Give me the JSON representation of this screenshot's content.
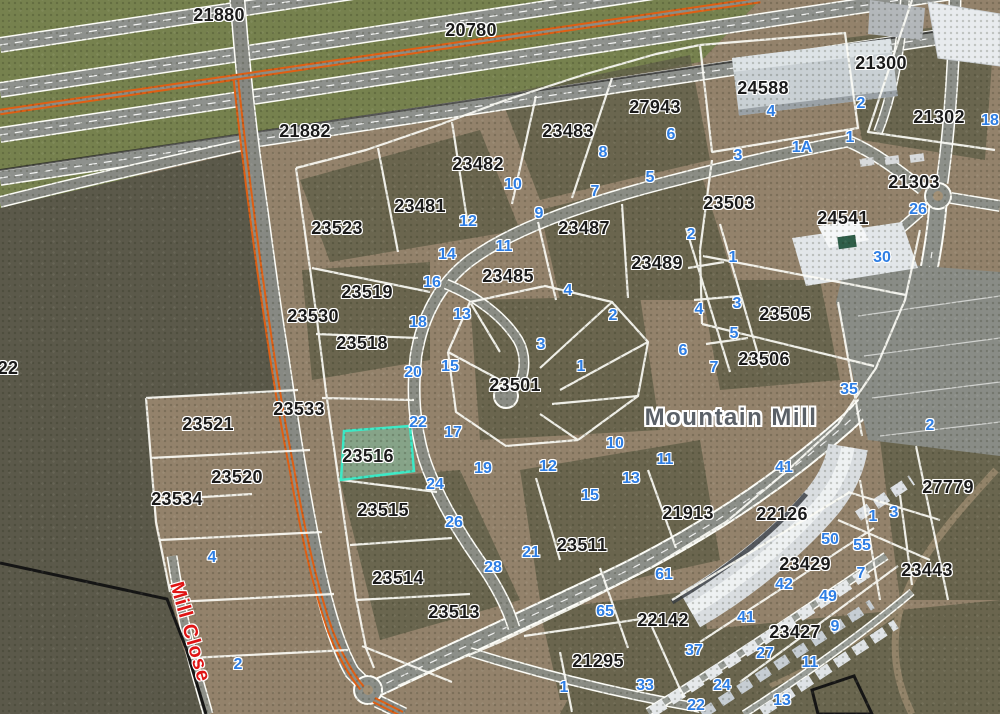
{
  "map": {
    "area_label": "Mountain Mill",
    "street_label": "Mill Close",
    "highlighted_parcel": {
      "id": "23516"
    },
    "colors": {
      "parcel_line": "#fbfbf5",
      "parcel_label": "#1a1a1a",
      "street_number": "#2e7ee4",
      "street_name": "#df1414",
      "area_label": "#5a6067",
      "route_overlay": "#df5f14",
      "highlight_fill": "#7cbfa0",
      "highlight_border": "#3ce9c6"
    },
    "parcel_labels": [
      {
        "t": "21880",
        "x": 219,
        "y": 15
      },
      {
        "t": "20780",
        "x": 471,
        "y": 30
      },
      {
        "t": "21882",
        "x": 305,
        "y": 131
      },
      {
        "t": "24588",
        "x": 763,
        "y": 88
      },
      {
        "t": "21300",
        "x": 881,
        "y": 63
      },
      {
        "t": "27943",
        "x": 655,
        "y": 107
      },
      {
        "t": "23483",
        "x": 568,
        "y": 131
      },
      {
        "t": "21302",
        "x": 939,
        "y": 117
      },
      {
        "t": "23482",
        "x": 478,
        "y": 164
      },
      {
        "t": "21303",
        "x": 914,
        "y": 182
      },
      {
        "t": "24541",
        "x": 843,
        "y": 218
      },
      {
        "t": "23481",
        "x": 420,
        "y": 206
      },
      {
        "t": "23523",
        "x": 337,
        "y": 228
      },
      {
        "t": "23487",
        "x": 584,
        "y": 228
      },
      {
        "t": "23503",
        "x": 729,
        "y": 203
      },
      {
        "t": "23489",
        "x": 657,
        "y": 263
      },
      {
        "t": "23485",
        "x": 508,
        "y": 276
      },
      {
        "t": "23519",
        "x": 367,
        "y": 292
      },
      {
        "t": "23530",
        "x": 313,
        "y": 316
      },
      {
        "t": "23505",
        "x": 785,
        "y": 314
      },
      {
        "t": "23518",
        "x": 362,
        "y": 343
      },
      {
        "t": "23506",
        "x": 764,
        "y": 359
      },
      {
        "t": "22",
        "x": 8,
        "y": 368
      },
      {
        "t": "23501",
        "x": 515,
        "y": 385
      },
      {
        "t": "23533",
        "x": 299,
        "y": 409
      },
      {
        "t": "23521",
        "x": 208,
        "y": 424
      },
      {
        "t": "23516",
        "x": 368,
        "y": 456
      },
      {
        "t": "23520",
        "x": 237,
        "y": 477
      },
      {
        "t": "27779",
        "x": 948,
        "y": 487
      },
      {
        "t": "23534",
        "x": 177,
        "y": 499
      },
      {
        "t": "23515",
        "x": 383,
        "y": 510
      },
      {
        "t": "21913",
        "x": 688,
        "y": 513
      },
      {
        "t": "22126",
        "x": 782,
        "y": 514
      },
      {
        "t": "23511",
        "x": 582,
        "y": 545
      },
      {
        "t": "23429",
        "x": 805,
        "y": 564
      },
      {
        "t": "23443",
        "x": 927,
        "y": 570
      },
      {
        "t": "23514",
        "x": 398,
        "y": 578
      },
      {
        "t": "23513",
        "x": 454,
        "y": 612
      },
      {
        "t": "22142",
        "x": 663,
        "y": 620
      },
      {
        "t": "23427",
        "x": 795,
        "y": 632
      },
      {
        "t": "21295",
        "x": 598,
        "y": 661
      }
    ],
    "street_numbers": [
      {
        "t": "2",
        "x": 861,
        "y": 104
      },
      {
        "t": "4",
        "x": 771,
        "y": 112
      },
      {
        "t": "18",
        "x": 990,
        "y": 121
      },
      {
        "t": "6",
        "x": 671,
        "y": 135
      },
      {
        "t": "1",
        "x": 850,
        "y": 138
      },
      {
        "t": "1A",
        "x": 802,
        "y": 148
      },
      {
        "t": "8",
        "x": 603,
        "y": 153
      },
      {
        "t": "3",
        "x": 738,
        "y": 156
      },
      {
        "t": "5",
        "x": 650,
        "y": 178
      },
      {
        "t": "10",
        "x": 513,
        "y": 185
      },
      {
        "t": "7",
        "x": 595,
        "y": 192
      },
      {
        "t": "26",
        "x": 918,
        "y": 210
      },
      {
        "t": "9",
        "x": 539,
        "y": 214
      },
      {
        "t": "12",
        "x": 468,
        "y": 222
      },
      {
        "t": "2",
        "x": 691,
        "y": 235
      },
      {
        "t": "11",
        "x": 504,
        "y": 247
      },
      {
        "t": "14",
        "x": 447,
        "y": 255
      },
      {
        "t": "1",
        "x": 733,
        "y": 258
      },
      {
        "t": "30",
        "x": 882,
        "y": 258
      },
      {
        "t": "16",
        "x": 432,
        "y": 283
      },
      {
        "t": "4",
        "x": 568,
        "y": 291
      },
      {
        "t": "3",
        "x": 737,
        "y": 304
      },
      {
        "t": "4",
        "x": 699,
        "y": 310
      },
      {
        "t": "13",
        "x": 462,
        "y": 315
      },
      {
        "t": "2",
        "x": 613,
        "y": 316
      },
      {
        "t": "18",
        "x": 418,
        "y": 323
      },
      {
        "t": "5",
        "x": 734,
        "y": 334
      },
      {
        "t": "3",
        "x": 541,
        "y": 345
      },
      {
        "t": "6",
        "x": 683,
        "y": 351
      },
      {
        "t": "15",
        "x": 450,
        "y": 367
      },
      {
        "t": "1",
        "x": 581,
        "y": 367
      },
      {
        "t": "7",
        "x": 714,
        "y": 368
      },
      {
        "t": "20",
        "x": 413,
        "y": 373
      },
      {
        "t": "35",
        "x": 849,
        "y": 390
      },
      {
        "t": "22",
        "x": 418,
        "y": 423
      },
      {
        "t": "2",
        "x": 930,
        "y": 426
      },
      {
        "t": "17",
        "x": 453,
        "y": 433
      },
      {
        "t": "10",
        "x": 615,
        "y": 444
      },
      {
        "t": "11",
        "x": 665,
        "y": 460
      },
      {
        "t": "41",
        "x": 784,
        "y": 468
      },
      {
        "t": "12",
        "x": 548,
        "y": 467
      },
      {
        "t": "19",
        "x": 483,
        "y": 469
      },
      {
        "t": "13",
        "x": 631,
        "y": 479
      },
      {
        "t": "24",
        "x": 435,
        "y": 485
      },
      {
        "t": "15",
        "x": 590,
        "y": 496
      },
      {
        "t": "3",
        "x": 894,
        "y": 513
      },
      {
        "t": "1",
        "x": 873,
        "y": 517
      },
      {
        "t": "26",
        "x": 454,
        "y": 523
      },
      {
        "t": "50",
        "x": 830,
        "y": 540
      },
      {
        "t": "55",
        "x": 862,
        "y": 546
      },
      {
        "t": "21",
        "x": 531,
        "y": 553
      },
      {
        "t": "4",
        "x": 212,
        "y": 558
      },
      {
        "t": "28",
        "x": 493,
        "y": 568
      },
      {
        "t": "61",
        "x": 664,
        "y": 575
      },
      {
        "t": "7",
        "x": 861,
        "y": 574
      },
      {
        "t": "42",
        "x": 784,
        "y": 585
      },
      {
        "t": "49",
        "x": 828,
        "y": 597
      },
      {
        "t": "65",
        "x": 605,
        "y": 612
      },
      {
        "t": "41",
        "x": 746,
        "y": 618
      },
      {
        "t": "9",
        "x": 835,
        "y": 627
      },
      {
        "t": "37",
        "x": 694,
        "y": 651
      },
      {
        "t": "27",
        "x": 765,
        "y": 654
      },
      {
        "t": "11",
        "x": 810,
        "y": 663
      },
      {
        "t": "2",
        "x": 238,
        "y": 665
      },
      {
        "t": "33",
        "x": 645,
        "y": 686
      },
      {
        "t": "24",
        "x": 722,
        "y": 686
      },
      {
        "t": "1",
        "x": 564,
        "y": 688
      },
      {
        "t": "13",
        "x": 782,
        "y": 701
      },
      {
        "t": "22",
        "x": 696,
        "y": 706
      }
    ]
  }
}
